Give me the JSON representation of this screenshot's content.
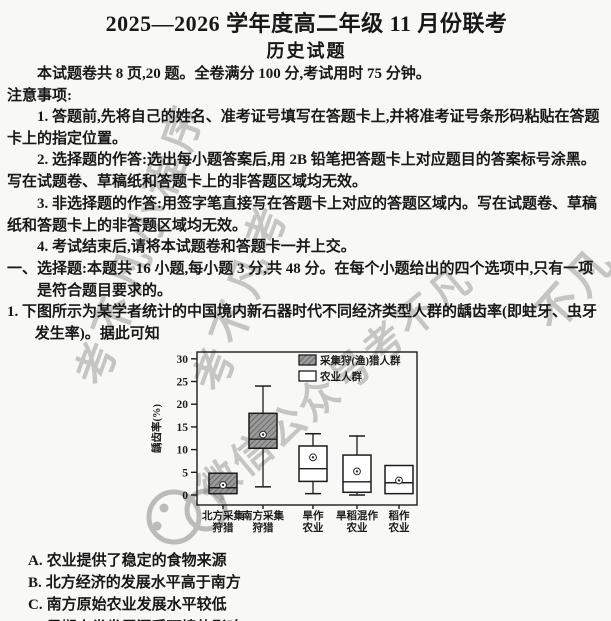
{
  "page": {
    "title": "2025—2026 学年度高二年级 11 月份联考",
    "subtitle": "历史试题",
    "meta_line": "本试题卷共 8 页,20 题。全卷满分 100 分,考试用时 75 分钟。",
    "notice_heading": "注意事项:"
  },
  "notices": {
    "items": [
      {
        "text": "1. 答题前,先将自己的姓名、准考证号填写在答题卡上,并将准考证号条形码粘贴在答题卡上的指定位置。"
      },
      {
        "text": "2. 选择题的作答:选出每小题答案后,用 2B 铅笔把答题卡上对应题目的答案标号涂黑。写在试题卷、草稿纸和答题卡上的非答题区域均无效。"
      },
      {
        "text": "3. 非选择题的作答:用签字笔直接写在答题卡上对应的答题区域内。写在试题卷、草稿纸和答题卡上的非答题区域均无效。"
      },
      {
        "text": "4. 考试结束后,请将本试题卷和答题卡一并上交。"
      }
    ]
  },
  "section": {
    "heading": "一、选择题:本题共 16 小题,每小题 3 分,共 48 分。在每个小题给出的四个选项中,只有一项是符合题目要求的。"
  },
  "question": {
    "number": "1. ",
    "text": "下图所示为某学者统计的中国境内新石器时代不同经济类型人群的龋齿率(即蛀牙、虫牙发生率)。据此可知",
    "options": [
      {
        "label": "A.",
        "text": "农业提供了稳定的食物来源"
      },
      {
        "label": "B.",
        "text": "北方经济的发展水平高于南方"
      },
      {
        "label": "C.",
        "text": "南方原始农业发展水平较低"
      },
      {
        "label": "D.",
        "text": "早期人类发展深受环境的影响"
      }
    ]
  },
  "chart_data": {
    "type": "boxplot",
    "title": "",
    "xlabel": "",
    "ylabel": "龋齿率(%)",
    "yticks": [
      0,
      5,
      10,
      15,
      20,
      25,
      30
    ],
    "ylim": [
      -2.2,
      31.5
    ],
    "grid": false,
    "legend_position": "top-right-inside",
    "legend": [
      {
        "label": "采集狩(渔)猎人群",
        "fill": "hatched",
        "color": "#9a9a9a"
      },
      {
        "label": "农业人群",
        "fill": "solid",
        "color": "#ffffff"
      }
    ],
    "categories": [
      [
        "北方采集",
        "狩猎"
      ],
      [
        "南方采集",
        "狩猎"
      ],
      [
        "旱作",
        "农业"
      ],
      [
        "旱稻混作",
        "农业"
      ],
      [
        "稻作",
        "农业"
      ]
    ],
    "boxes": [
      {
        "category": "北方采集狩猎",
        "group": 0,
        "whisker_low": null,
        "q1": 0.3,
        "median": 1.6,
        "q3": 4.8,
        "whisker_high": null,
        "mean": 2.2
      },
      {
        "category": "南方采集狩猎",
        "group": 0,
        "whisker_low": 1.8,
        "q1": 10.3,
        "median": 12.3,
        "q3": 18.0,
        "whisker_high": 24.0,
        "mean": 13.3
      },
      {
        "category": "旱作农业",
        "group": 1,
        "whisker_low": 0.3,
        "q1": 3.0,
        "median": 5.8,
        "q3": 10.8,
        "whisker_high": 13.5,
        "mean": 8.3
      },
      {
        "category": "旱稻混作农业",
        "group": 1,
        "whisker_low": 0.0,
        "q1": 0.6,
        "median": 2.9,
        "q3": 8.8,
        "whisker_high": 13.0,
        "mean": 5.2
      },
      {
        "category": "稻作农业",
        "group": 1,
        "whisker_low": null,
        "q1": 0.3,
        "median": 2.7,
        "q3": 6.5,
        "whisker_high": null,
        "mean": 3.2
      }
    ],
    "x_centers": [
      78,
      118,
      168,
      212,
      254
    ],
    "box_width": 28
  },
  "watermarks": {
    "color": "#6e6e6e",
    "items": [
      {
        "text": "考不凡小程序",
        "x": 58,
        "y": 372,
        "rotate": -70,
        "size": 42,
        "spacing": 8
      },
      {
        "text": "考不凡考",
        "x": 176,
        "y": 378,
        "rotate": -70,
        "size": 42,
        "spacing": 8
      },
      {
        "text": "微信公众号考不凡",
        "x": 183,
        "y": 470,
        "rotate": -40,
        "size": 40,
        "spacing": 3
      },
      {
        "text": "不凡",
        "x": 516,
        "y": 300,
        "rotate": -48,
        "size": 44,
        "spacing": 4
      }
    ]
  }
}
